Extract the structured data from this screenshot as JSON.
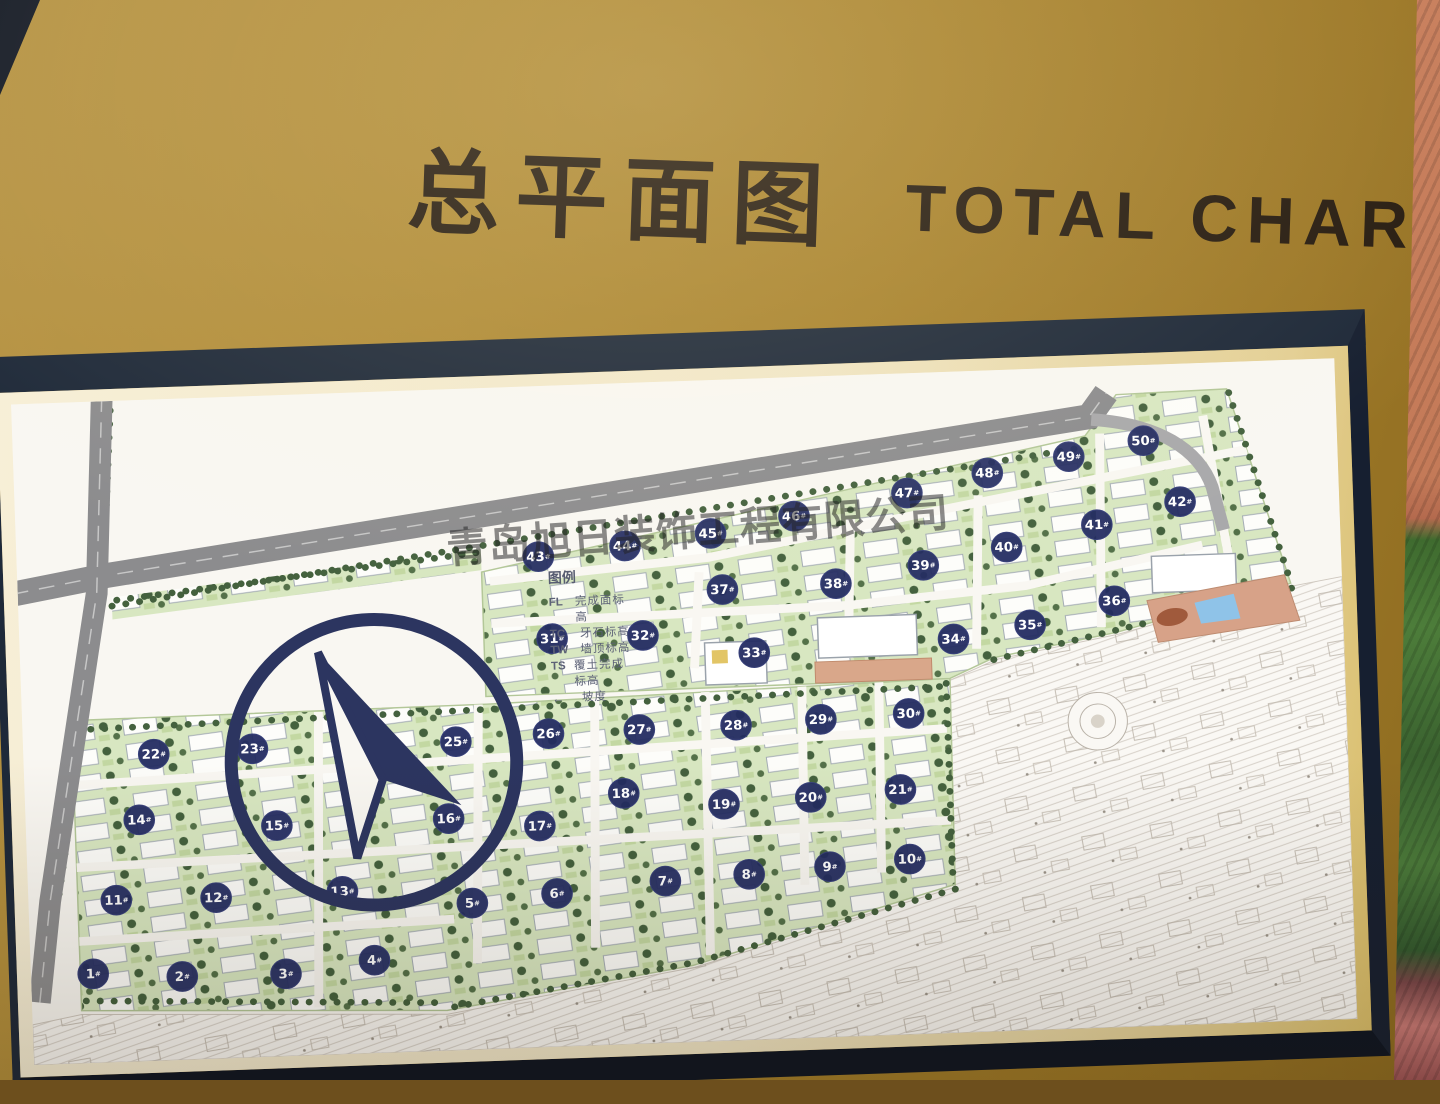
{
  "title": {
    "cn": "总平面图",
    "en": "TOTAL CHART"
  },
  "watermark": "青岛旭日装饰工程有限公司",
  "legend": {
    "title": "图例",
    "items": [
      {
        "code": "FL",
        "label": "完成面标高"
      },
      {
        "code": "TC",
        "label": "牙石标高"
      },
      {
        "code": "TW",
        "label": "墙顶标高"
      },
      {
        "code": "TS",
        "label": "覆土完成标高"
      },
      {
        "code": "",
        "icon": "slope-arrow",
        "label": "坡度"
      }
    ]
  },
  "map": {
    "marker_suffix": "#",
    "buildings": [
      {
        "no": 1,
        "x": 63,
        "y": 597
      },
      {
        "no": 2,
        "x": 153,
        "y": 603
      },
      {
        "no": 3,
        "x": 258,
        "y": 604
      },
      {
        "no": 4,
        "x": 348,
        "y": 593
      },
      {
        "no": 5,
        "x": 449,
        "y": 537
      },
      {
        "no": 6,
        "x": 535,
        "y": 530
      },
      {
        "no": 7,
        "x": 645,
        "y": 521
      },
      {
        "no": 8,
        "x": 730,
        "y": 517
      },
      {
        "no": 9,
        "x": 812,
        "y": 512
      },
      {
        "no": 10,
        "x": 893,
        "y": 507
      },
      {
        "no": 11,
        "x": 89,
        "y": 521
      },
      {
        "no": 12,
        "x": 190,
        "y": 522
      },
      {
        "no": 13,
        "x": 318,
        "y": 520
      },
      {
        "no": 14,
        "x": 115,
        "y": 438
      },
      {
        "no": 15,
        "x": 254,
        "y": 449
      },
      {
        "no": 16,
        "x": 428,
        "y": 448
      },
      {
        "no": 17,
        "x": 520,
        "y": 459
      },
      {
        "no": 18,
        "x": 606,
        "y": 428
      },
      {
        "no": 19,
        "x": 707,
        "y": 443
      },
      {
        "no": 20,
        "x": 795,
        "y": 439
      },
      {
        "no": 21,
        "x": 886,
        "y": 434
      },
      {
        "no": 22,
        "x": 132,
        "y": 370
      },
      {
        "no": 23,
        "x": 232,
        "y": 368
      },
      {
        "no": 24,
        "x": 355,
        "y": 370
      },
      {
        "no": 25,
        "x": 438,
        "y": 368
      },
      {
        "no": 26,
        "x": 532,
        "y": 363
      },
      {
        "no": 27,
        "x": 624,
        "y": 362
      },
      {
        "no": 28,
        "x": 722,
        "y": 361
      },
      {
        "no": 29,
        "x": 808,
        "y": 358
      },
      {
        "no": 30,
        "x": 897,
        "y": 355
      },
      {
        "no": 31,
        "x": 539,
        "y": 264
      },
      {
        "no": 32,
        "x": 631,
        "y": 264
      },
      {
        "no": 33,
        "x": 743,
        "y": 286
      },
      {
        "no": 34,
        "x": 945,
        "y": 279
      },
      {
        "no": 35,
        "x": 1023,
        "y": 267
      },
      {
        "no": 36,
        "x": 1109,
        "y": 245
      },
      {
        "no": 37,
        "x": 713,
        "y": 219
      },
      {
        "no": 38,
        "x": 828,
        "y": 217
      },
      {
        "no": 39,
        "x": 917,
        "y": 201
      },
      {
        "no": 40,
        "x": 1002,
        "y": 185
      },
      {
        "no": 41,
        "x": 1094,
        "y": 165
      },
      {
        "no": 42,
        "x": 1179,
        "y": 144
      },
      {
        "no": 43,
        "x": 528,
        "y": 178
      },
      {
        "no": 44,
        "x": 616,
        "y": 170
      },
      {
        "no": 45,
        "x": 703,
        "y": 160
      },
      {
        "no": 46,
        "x": 788,
        "y": 145
      },
      {
        "no": 47,
        "x": 903,
        "y": 125
      },
      {
        "no": 48,
        "x": 985,
        "y": 107
      },
      {
        "no": 49,
        "x": 1068,
        "y": 93
      },
      {
        "no": 50,
        "x": 1144,
        "y": 79
      }
    ]
  },
  "colors": {
    "board_gold": "#a8822c",
    "frame_dark": "#1e2939",
    "mat_cream": "#f1e6c6",
    "map_paper": "#f9f7f2",
    "road_gray": "#8c8c8e",
    "residential_green": "#d8e7c1",
    "tree_green": "#44613e",
    "marker_navy": "#222b61",
    "wall_terracotta": "#c9815f",
    "hedge_green": "#487437",
    "leaf_red": "#b06a64"
  }
}
